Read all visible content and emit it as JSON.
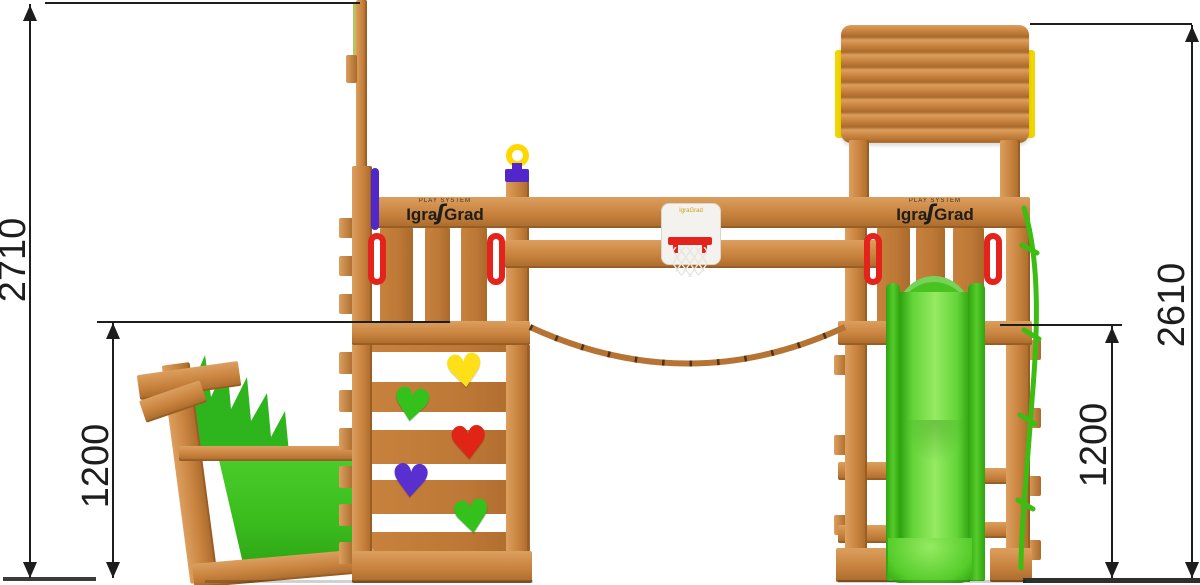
{
  "diagram": {
    "title": "playground set side elevation with overall and platform heights",
    "dimensions": {
      "left_total": "2710",
      "left_platform": "1200",
      "right_total": "2610",
      "right_platform": "1200"
    }
  },
  "brand": {
    "microtext": "PLAY SYSTEM",
    "part1": "Igra",
    "swoosh": "ʃ",
    "part2": "Grad",
    "board_logo": "IgraGrad"
  },
  "icons": {
    "heart": "♥"
  },
  "colors": {
    "wood_light": "#dc9f5e",
    "wood": "#c8823e",
    "wood_dark": "#a96a2b",
    "wood_deep": "#8a5420",
    "panel_green": "#3abb1d",
    "crest_green": "#2eb41d",
    "slide_green_dark": "#2ea30f",
    "slide_green_light": "#96ea62",
    "net_green": "#3bbd12",
    "heart_yellow": "#ffdf17",
    "heart_green": "#35c11c",
    "heart_red": "#e02517",
    "heart_purple": "#5a2fd0",
    "handle_red": "#e3231c",
    "telescope_yellow": "#ffd700",
    "telescope_purple": "#5127cc",
    "roof_yellow": "#f2d600",
    "rope": "#b57334",
    "rope_knot": "#53300f",
    "dim": "#1d1d1d",
    "ground": "#3c3c3c",
    "logo": "#1d1d1b",
    "board_white": "#f3f2ee",
    "board_logo_gold": "#cfa018"
  }
}
